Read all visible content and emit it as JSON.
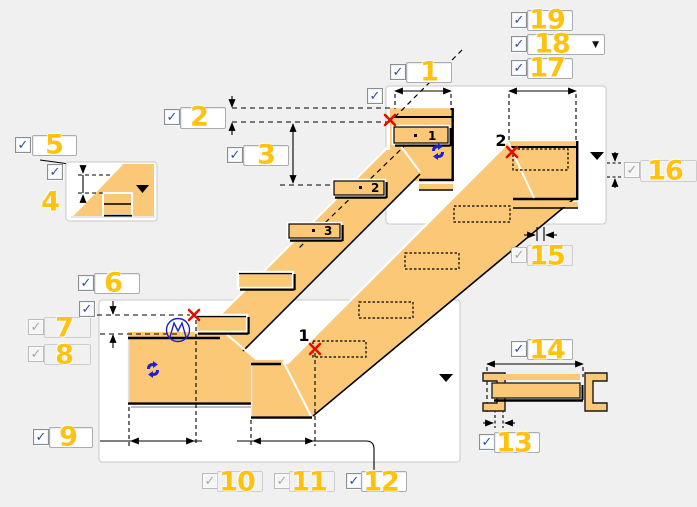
{
  "colors": {
    "background": "#f0f0f0",
    "panel": "#ffffff",
    "panel_border": "#c9c9c9",
    "stair_fill": "#fbc878",
    "callout_yellow": "#ffc20e",
    "check_blue": "#2b4fa2",
    "check_gray": "#a6a6a6",
    "marker_red": "#e01000",
    "icon_blue": "#2121cc",
    "line_black": "#000000"
  },
  "callouts": [
    {
      "n": "1",
      "cb": [
        390,
        64
      ],
      "state": "on",
      "kind": "input",
      "field": [
        406,
        62,
        44,
        19
      ],
      "label": [
        429,
        72
      ]
    },
    {
      "n": "2",
      "cb": [
        164,
        109
      ],
      "state": "on",
      "kind": "input",
      "field": [
        180,
        107,
        44,
        20
      ],
      "label": [
        199,
        117
      ]
    },
    {
      "n": "3",
      "cb": [
        227,
        147
      ],
      "state": "on",
      "kind": "input",
      "field": [
        243,
        145,
        44,
        19
      ],
      "label": [
        266,
        155
      ]
    },
    {
      "n": "4",
      "cb": [
        47,
        164
      ],
      "state": "on",
      "kind": "none",
      "label": [
        50,
        202
      ]
    },
    {
      "n": "5",
      "cb": [
        15,
        137
      ],
      "state": "on",
      "kind": "input",
      "field": [
        32,
        135,
        43,
        19
      ],
      "label": [
        54,
        145
      ]
    },
    {
      "n": "6",
      "cb": [
        78,
        275
      ],
      "state": "on",
      "kind": "input",
      "field": [
        94,
        273,
        44,
        19
      ],
      "label": [
        113,
        283
      ]
    },
    {
      "n": "7",
      "cb": [
        28,
        319
      ],
      "state": "disabled",
      "kind": "input",
      "field": [
        44,
        317,
        45,
        19
      ],
      "label": [
        64,
        328
      ]
    },
    {
      "n": "8",
      "cb": [
        28,
        346
      ],
      "state": "disabled",
      "kind": "input",
      "field": [
        44,
        344,
        45,
        19
      ],
      "label": [
        64,
        355
      ]
    },
    {
      "n": "9",
      "cb": [
        33,
        429
      ],
      "state": "on",
      "kind": "input",
      "field": [
        49,
        427,
        42,
        19
      ],
      "label": [
        68,
        437
      ]
    },
    {
      "n": "10",
      "cb": [
        202,
        473
      ],
      "state": "disabled",
      "kind": "input",
      "field": [
        217,
        471,
        44,
        19
      ],
      "label": [
        237,
        482
      ]
    },
    {
      "n": "11",
      "cb": [
        274,
        473
      ],
      "state": "disabled",
      "kind": "input",
      "field": [
        289,
        471,
        44,
        19
      ],
      "label": [
        309,
        482
      ]
    },
    {
      "n": "12",
      "cb": [
        346,
        473
      ],
      "state": "on",
      "kind": "input",
      "field": [
        361,
        471,
        44,
        19
      ],
      "label": [
        381,
        482
      ]
    },
    {
      "n": "13",
      "cb": [
        479,
        434
      ],
      "state": "on",
      "kind": "input",
      "field": [
        494,
        432,
        44,
        19
      ],
      "label": [
        514,
        443
      ]
    },
    {
      "n": "14",
      "cb": [
        511,
        341
      ],
      "state": "on",
      "kind": "input",
      "field": [
        527,
        339,
        44,
        19
      ],
      "label": [
        547,
        350
      ]
    },
    {
      "n": "15",
      "cb": [
        511,
        247
      ],
      "state": "disabled",
      "kind": "input",
      "field": [
        527,
        245,
        44,
        19
      ],
      "label": [
        547,
        256
      ]
    },
    {
      "n": "16",
      "cb": [
        624,
        162
      ],
      "state": "disabled",
      "kind": "input",
      "field": [
        640,
        160,
        55,
        20
      ],
      "label": [
        665,
        171
      ]
    },
    {
      "n": "17",
      "cb": [
        511,
        60
      ],
      "state": "on",
      "kind": "input",
      "field": [
        527,
        58,
        44,
        19
      ],
      "label": [
        547,
        68
      ]
    },
    {
      "n": "18",
      "cb": [
        511,
        36
      ],
      "state": "on",
      "kind": "dropdown",
      "field": [
        527,
        34,
        76,
        19
      ],
      "label": [
        552,
        44
      ]
    },
    {
      "n": "19",
      "cb": [
        511,
        12
      ],
      "state": "on",
      "kind": "input",
      "field": [
        527,
        10,
        44,
        19
      ],
      "label": [
        547,
        20
      ]
    }
  ],
  "aux_checkboxes": [
    {
      "id": "aux-checkbox-top",
      "cb": [
        367,
        88
      ],
      "state": "on"
    },
    {
      "id": "aux-checkbox-bottom",
      "cb": [
        79,
        301
      ],
      "state": "on"
    }
  ],
  "checkmark_glyph": "✓",
  "dropdown_glyph": "▼",
  "diagram": {
    "tread_labels": [
      "1",
      "2",
      "3"
    ],
    "point_markers": [
      {
        "label": "2",
        "note": "red-x at top end of right stair"
      },
      {
        "label": "1",
        "note": "red-x at bottom end of right stair"
      }
    ],
    "icons": [
      "swap-arrows-icon",
      "swap-arrows-icon",
      "angle-circle-icon",
      "dropdown-arrow",
      "dropdown-arrow",
      "dropdown-arrow"
    ]
  }
}
